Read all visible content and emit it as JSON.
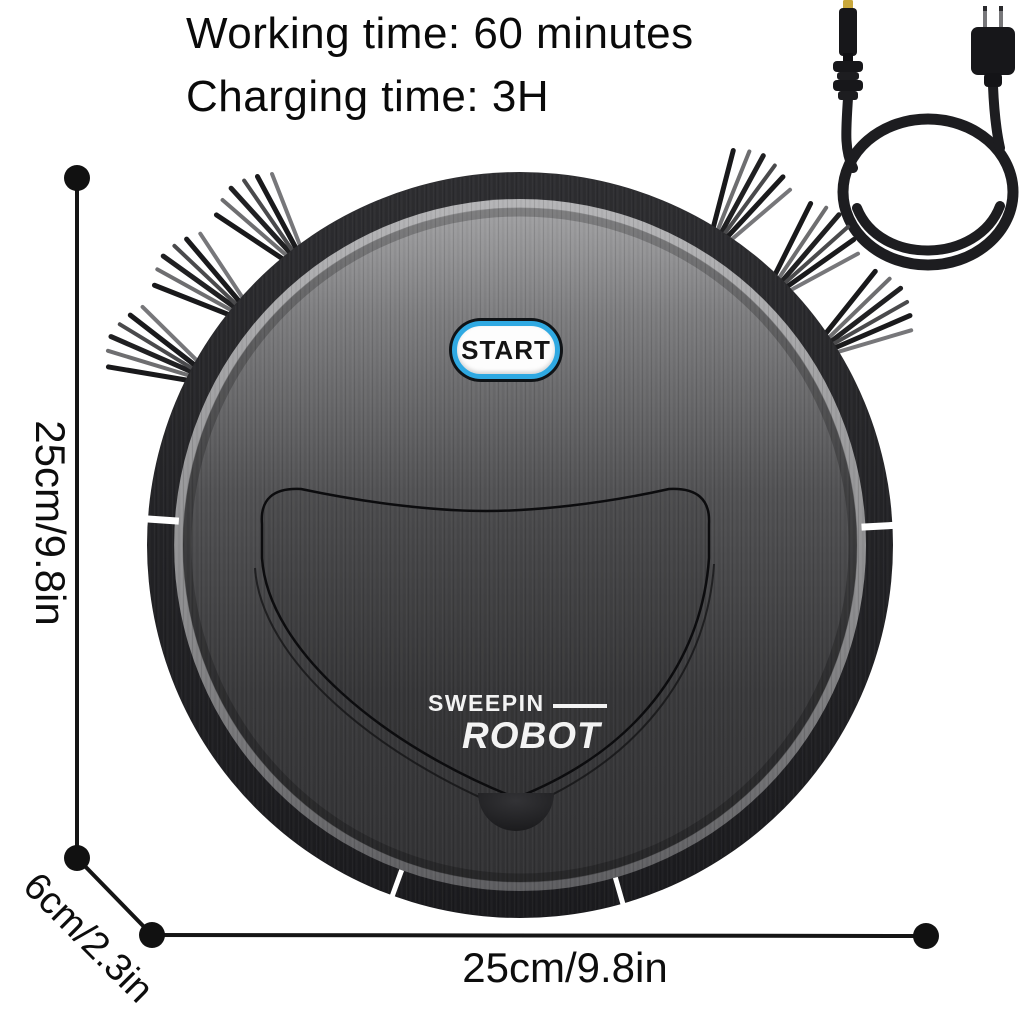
{
  "product_specs": {
    "working_time": "Working time: 60 minutes",
    "charging_time": "Charging time: 3H"
  },
  "robot": {
    "start_button_label": "START",
    "brand_line1": "SWEEPIN",
    "brand_line2": "ROBOT"
  },
  "dimensions": {
    "height_label": "25cm/9.8in",
    "depth_label": "6cm/2.3in",
    "width_label": "25cm/9.8in"
  },
  "colors": {
    "start_button_ring": "#2fa9e2",
    "dc_plug_tip": "#c9a83c",
    "annotation_ink": "#111111",
    "background": "#ffffff"
  }
}
